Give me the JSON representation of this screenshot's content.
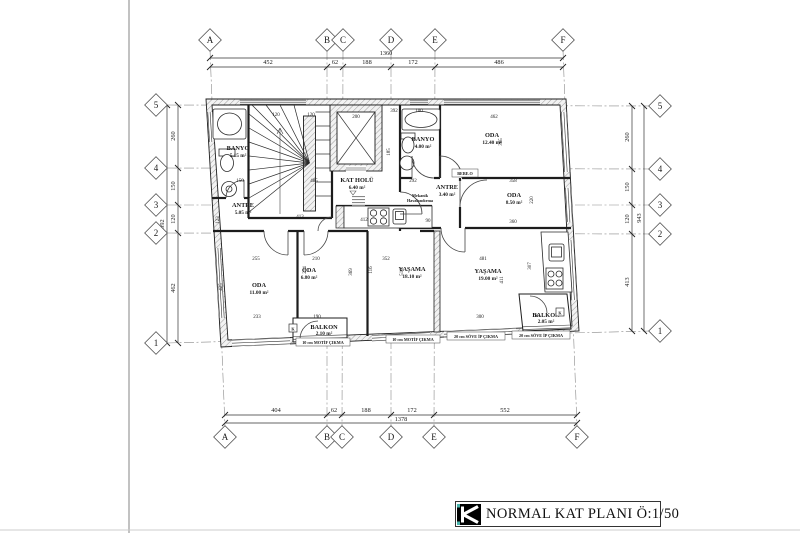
{
  "sheet": {
    "watermark": "TEKCE"
  },
  "title_block": {
    "title": "NORMAL KAT PLANI Ö:1/50"
  },
  "grid": {
    "cols": [
      "A",
      "B",
      "C",
      "D",
      "E",
      "F"
    ],
    "rows": [
      "5",
      "4",
      "3",
      "2",
      "1"
    ]
  },
  "dims": {
    "top": {
      "total": "1360",
      "seg": [
        "452",
        "62",
        "188",
        "172",
        "486"
      ]
    },
    "bottom": {
      "total": "1378",
      "seg": [
        "404",
        "62",
        "188",
        "172",
        "552"
      ]
    },
    "left": {
      "total": "992",
      "seg": [
        "260",
        "150",
        "120",
        "462"
      ]
    },
    "right": {
      "total": "943",
      "seg": [
        "260",
        "150",
        "120",
        "413"
      ]
    }
  },
  "rooms": {
    "banyo_a": {
      "name": "BANYO",
      "area": "5.15 m²"
    },
    "banyo_b": {
      "name": "BANYO",
      "area": "4.00 m²"
    },
    "oda_a": {
      "name": "ODA",
      "area": "12.40 m²"
    },
    "kat_holu": {
      "name": "KAT HOLÜ",
      "area": "6.40 m²"
    },
    "antre_b": {
      "name": "ANTRE",
      "area": "3.40 m²"
    },
    "oda_b": {
      "name": "ODA",
      "area": "8.50 m²"
    },
    "antre_a": {
      "name": "ANTRE",
      "area": "5.05 m²"
    },
    "oda_c": {
      "name": "ODA",
      "area": "11.00 m²"
    },
    "oda_d": {
      "name": "ODA",
      "area": "6.80 m²"
    },
    "yasama_a": {
      "name": "YAŞAMA",
      "area": "18.10 m²"
    },
    "yasama_b": {
      "name": "YAŞAMA",
      "area": "19.00 m²"
    },
    "balkon_a": {
      "name": "BALKON",
      "area": "2.10 m²"
    },
    "balkon_b": {
      "name": "BALKON",
      "area": "2.05 m²"
    }
  },
  "notes": {
    "mech_line1": "Mekanik",
    "mech_line2": "Havalandırma",
    "bebe": "BEBE.O",
    "cikma_left": "10 cm MOTİF ÇIKMA",
    "cikma_mid": "10 cm MOTİF ÇIKMA",
    "cikma_right1": "20 cm SÖVE İP ÇIKMA",
    "cikma_right2": "20 cm SÖVE İP ÇIKMA",
    "k_label": "K"
  },
  "inner_dims": {
    "d01": "200",
    "d02": "462",
    "d03": "392",
    "d04": "120",
    "d05": "120",
    "d06": "150",
    "d07": "485",
    "d08": "292",
    "d09": "358",
    "d10": "413",
    "d11": "412",
    "d12": "90",
    "d13": "360",
    "d14": "365",
    "d15": "220",
    "d16": "185",
    "d17": "100",
    "d18": "255",
    "d19": "210",
    "d20": "352",
    "d21": "481",
    "d22": "233",
    "d23": "190",
    "d24": "300",
    "d25": "168",
    "d26": "425",
    "d27": "123",
    "d28": "214",
    "d29": "369",
    "d30": "516",
    "d31": "411",
    "d32": "116",
    "d33": "307"
  }
}
